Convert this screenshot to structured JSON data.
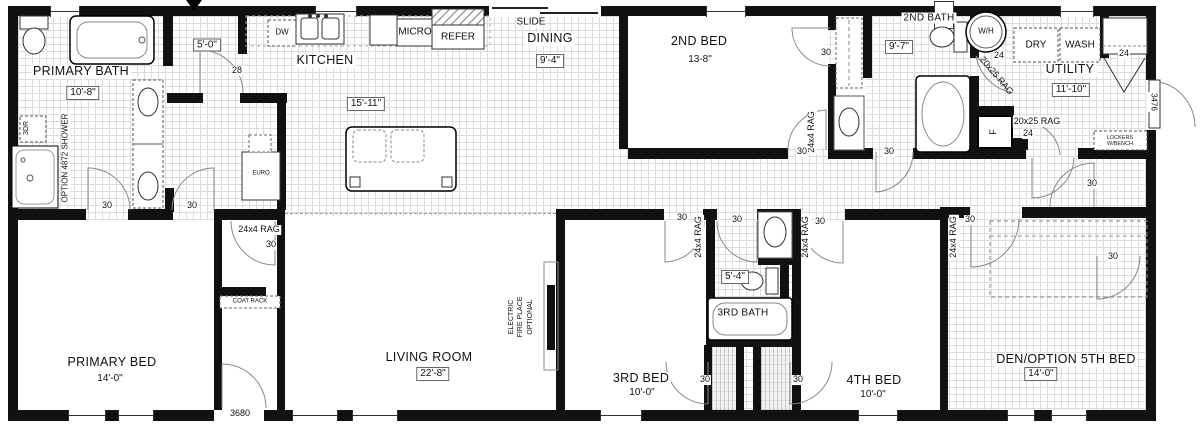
{
  "plan": {
    "rooms": [
      {
        "name": "PRIMARY BATH",
        "dim": "10'-8\"",
        "x": 81,
        "y": 72,
        "dx": 83,
        "dy": 93,
        "box": true
      },
      {
        "name": "KITCHEN",
        "dim": "15'-11\"",
        "x": 325,
        "y": 61,
        "dx": 366,
        "dy": 104,
        "box": true
      },
      {
        "name": "DINING",
        "dim": "9'-4\"",
        "x": 550,
        "y": 39,
        "dx": 550,
        "dy": 61,
        "box": true
      },
      {
        "name": "2ND BED",
        "dim": "13-8\"",
        "x": 699,
        "y": 42,
        "dx": 700,
        "dy": 60,
        "box": false
      },
      {
        "name": "2ND BATH",
        "dim": "9'-7\"",
        "x": 929,
        "y": 18,
        "dx": 899,
        "dy": 47,
        "box": true,
        "fs": 10
      },
      {
        "name": "UTILITY",
        "dim": "11'-10\"",
        "x": 1070,
        "y": 70,
        "dx": 1071,
        "dy": 90,
        "box": true
      },
      {
        "name": "PRIMARY BED",
        "dim": "14'-0\"",
        "x": 112,
        "y": 363,
        "dx": 110,
        "dy": 379,
        "box": false
      },
      {
        "name": "LIVING ROOM",
        "dim": "22'-8\"",
        "x": 429,
        "y": 358,
        "dx": 433,
        "dy": 374,
        "box": true
      },
      {
        "name": "3RD BED",
        "dim": "10'-0\"",
        "x": 641,
        "y": 379,
        "dx": 642,
        "dy": 393,
        "box": false
      },
      {
        "name": "3RD BATH",
        "dim": "5'-4\"",
        "x": 743,
        "y": 313,
        "dx": 735,
        "dy": 277,
        "box": true,
        "namebox": true
      },
      {
        "name": "4TH BED",
        "dim": "10'-0\"",
        "x": 874,
        "y": 381,
        "dx": 873,
        "dy": 395,
        "box": false
      },
      {
        "name": "DEN/OPTION 5TH BED",
        "dim": "14'-0\"",
        "x": 1066,
        "y": 360,
        "dx": 1041,
        "dy": 374,
        "box": true
      }
    ],
    "annotations": [
      {
        "t": "5'-0\"",
        "x": 207,
        "y": 45,
        "k": "dimbox"
      },
      {
        "t": "28",
        "x": 237,
        "y": 71,
        "k": ""
      },
      {
        "t": "30",
        "x": 107,
        "y": 206,
        "k": ""
      },
      {
        "t": "30",
        "x": 192,
        "y": 206,
        "k": ""
      },
      {
        "t": "3DR",
        "x": 27,
        "y": 128,
        "k": "v",
        "fs": 7
      },
      {
        "t": "OPTION 4872 SHOWER",
        "x": 66,
        "y": 158,
        "k": "v",
        "fs": 8
      },
      {
        "t": "24x4 RAG",
        "x": 259,
        "y": 230,
        "k": ""
      },
      {
        "t": "30",
        "x": 271,
        "y": 245,
        "k": ""
      },
      {
        "t": "3680",
        "x": 240,
        "y": 414,
        "k": ""
      },
      {
        "t": "30",
        "x": 826,
        "y": 53,
        "k": ""
      },
      {
        "t": "24x4 RAG",
        "x": 812,
        "y": 132,
        "k": "v"
      },
      {
        "t": "30",
        "x": 802,
        "y": 152,
        "k": ""
      },
      {
        "t": "30",
        "x": 889,
        "y": 152,
        "k": ""
      },
      {
        "t": "24",
        "x": 999,
        "y": 56,
        "k": ""
      },
      {
        "t": "20x25 RAG",
        "x": 996,
        "y": 76,
        "k": "r50"
      },
      {
        "t": "20x25 RAG",
        "x": 1037,
        "y": 122,
        "k": ""
      },
      {
        "t": "24",
        "x": 1028,
        "y": 134,
        "k": ""
      },
      {
        "t": "F",
        "x": 994,
        "y": 132,
        "k": "v"
      },
      {
        "t": "24",
        "x": 1124,
        "y": 54,
        "k": ""
      },
      {
        "t": "3476",
        "x": 1153,
        "y": 102,
        "k": "vd",
        "fs": 8
      },
      {
        "t": "30",
        "x": 1092,
        "y": 184,
        "k": ""
      },
      {
        "t": "30",
        "x": 970,
        "y": 220,
        "k": ""
      },
      {
        "t": "24x4 RAG",
        "x": 954,
        "y": 237,
        "k": "v"
      },
      {
        "t": "30",
        "x": 1113,
        "y": 257,
        "k": ""
      },
      {
        "t": "30",
        "x": 682,
        "y": 218,
        "k": ""
      },
      {
        "t": "24x4 RAG",
        "x": 699,
        "y": 237,
        "k": "v"
      },
      {
        "t": "30",
        "x": 737,
        "y": 220,
        "k": ""
      },
      {
        "t": "24x4 RAG",
        "x": 806,
        "y": 237,
        "k": "v"
      },
      {
        "t": "30",
        "x": 820,
        "y": 222,
        "k": ""
      },
      {
        "t": "30",
        "x": 705,
        "y": 380,
        "k": ""
      },
      {
        "t": "30",
        "x": 798,
        "y": 380,
        "k": ""
      }
    ],
    "fixtures": {
      "dw": "DW",
      "micro": "MICRO",
      "refer": "REFER",
      "slide": "SLIDE",
      "wh": "W/H",
      "dry": "DRY",
      "wash": "WASH",
      "euro": "EURO",
      "coat_rack": "COAT RACK",
      "lockers": "LOCKERS W/BENCH",
      "fireplace": "ELECTRIC\nFIRE PLACE\nOPTIONAL"
    }
  }
}
